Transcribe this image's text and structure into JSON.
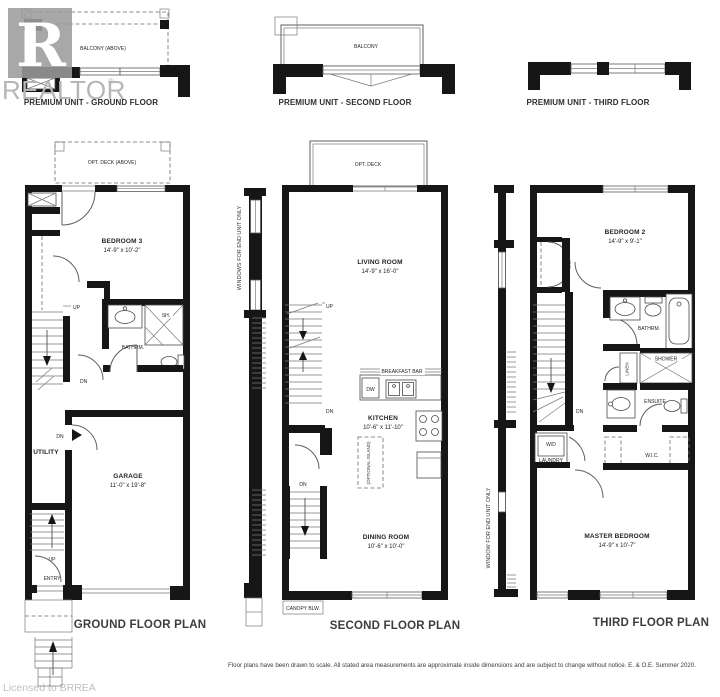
{
  "watermark": {
    "logo_letter": "R",
    "brand": "REALTOR",
    "reg": "®",
    "license": "Licensed to BRREA"
  },
  "units": {
    "ground": {
      "label": "PREMIUM UNIT - GROUND FLOOR",
      "balcony": "BALCONY (ABOVE)"
    },
    "second": {
      "label": "PREMIUM UNIT - SECOND FLOOR",
      "balcony": "BALCONY"
    },
    "third": {
      "label": "PREMIUM UNIT - THIRD FLOOR"
    }
  },
  "ground": {
    "title": "GROUND FLOOR PLAN",
    "deck": "OPT. DECK (ABOVE)",
    "bedroom3": "BEDROOM 3",
    "bedroom3_dims": "14'-9\" x 10'-2\"",
    "bathroom": "BATHRM.",
    "shower": "SH.",
    "utility": "UTILITY",
    "garage": "GARAGE",
    "garage_dims": "11'-0\" x 19'-8\"",
    "entry": "ENTRY",
    "up": "UP",
    "dn": "DN"
  },
  "second": {
    "title": "SECOND FLOOR PLAN",
    "deck": "OPT. DECK",
    "side_note": "WINDOWS FOR END UNIT ONLY",
    "living": "LIVING ROOM",
    "living_dims": "14'-9\" x 16'-0\"",
    "breakfast_bar": "BREAKFAST BAR",
    "dw": "DW",
    "kitchen": "KITCHEN",
    "kitchen_dims": "10'-6\" x 11'-10\"",
    "island": "(OPTIONAL ISLAND)",
    "dining": "DINING ROOM",
    "dining_dims": "10'-6\" x 10'-0\"",
    "canopy": "CANOPY BLW.",
    "up": "UP",
    "dn": "DN"
  },
  "third": {
    "title": "THIRD FLOOR PLAN",
    "side_note": "WINDOW FOR END UNIT ONLY",
    "bedroom2": "BEDROOM 2",
    "bedroom2_dims": "14'-9\" x 9'-1\"",
    "bathroom": "BATHRM.",
    "linen": "LINEN",
    "shower": "SHOWER",
    "ensuite": "ENSUITE",
    "wd": "W/D",
    "laundry": "LAUNDRY",
    "wic": "W.I.C.",
    "master": "MASTER BEDROOM",
    "master_dims": "14'-9\" x 10'-7\"",
    "dn": "DN"
  },
  "footer": {
    "disclaimer": "Floor plans have been drawn to scale. All stated area measurements are approximate inside dimensions and are subject to change without notice. E. & O.E. Summer 2020."
  }
}
